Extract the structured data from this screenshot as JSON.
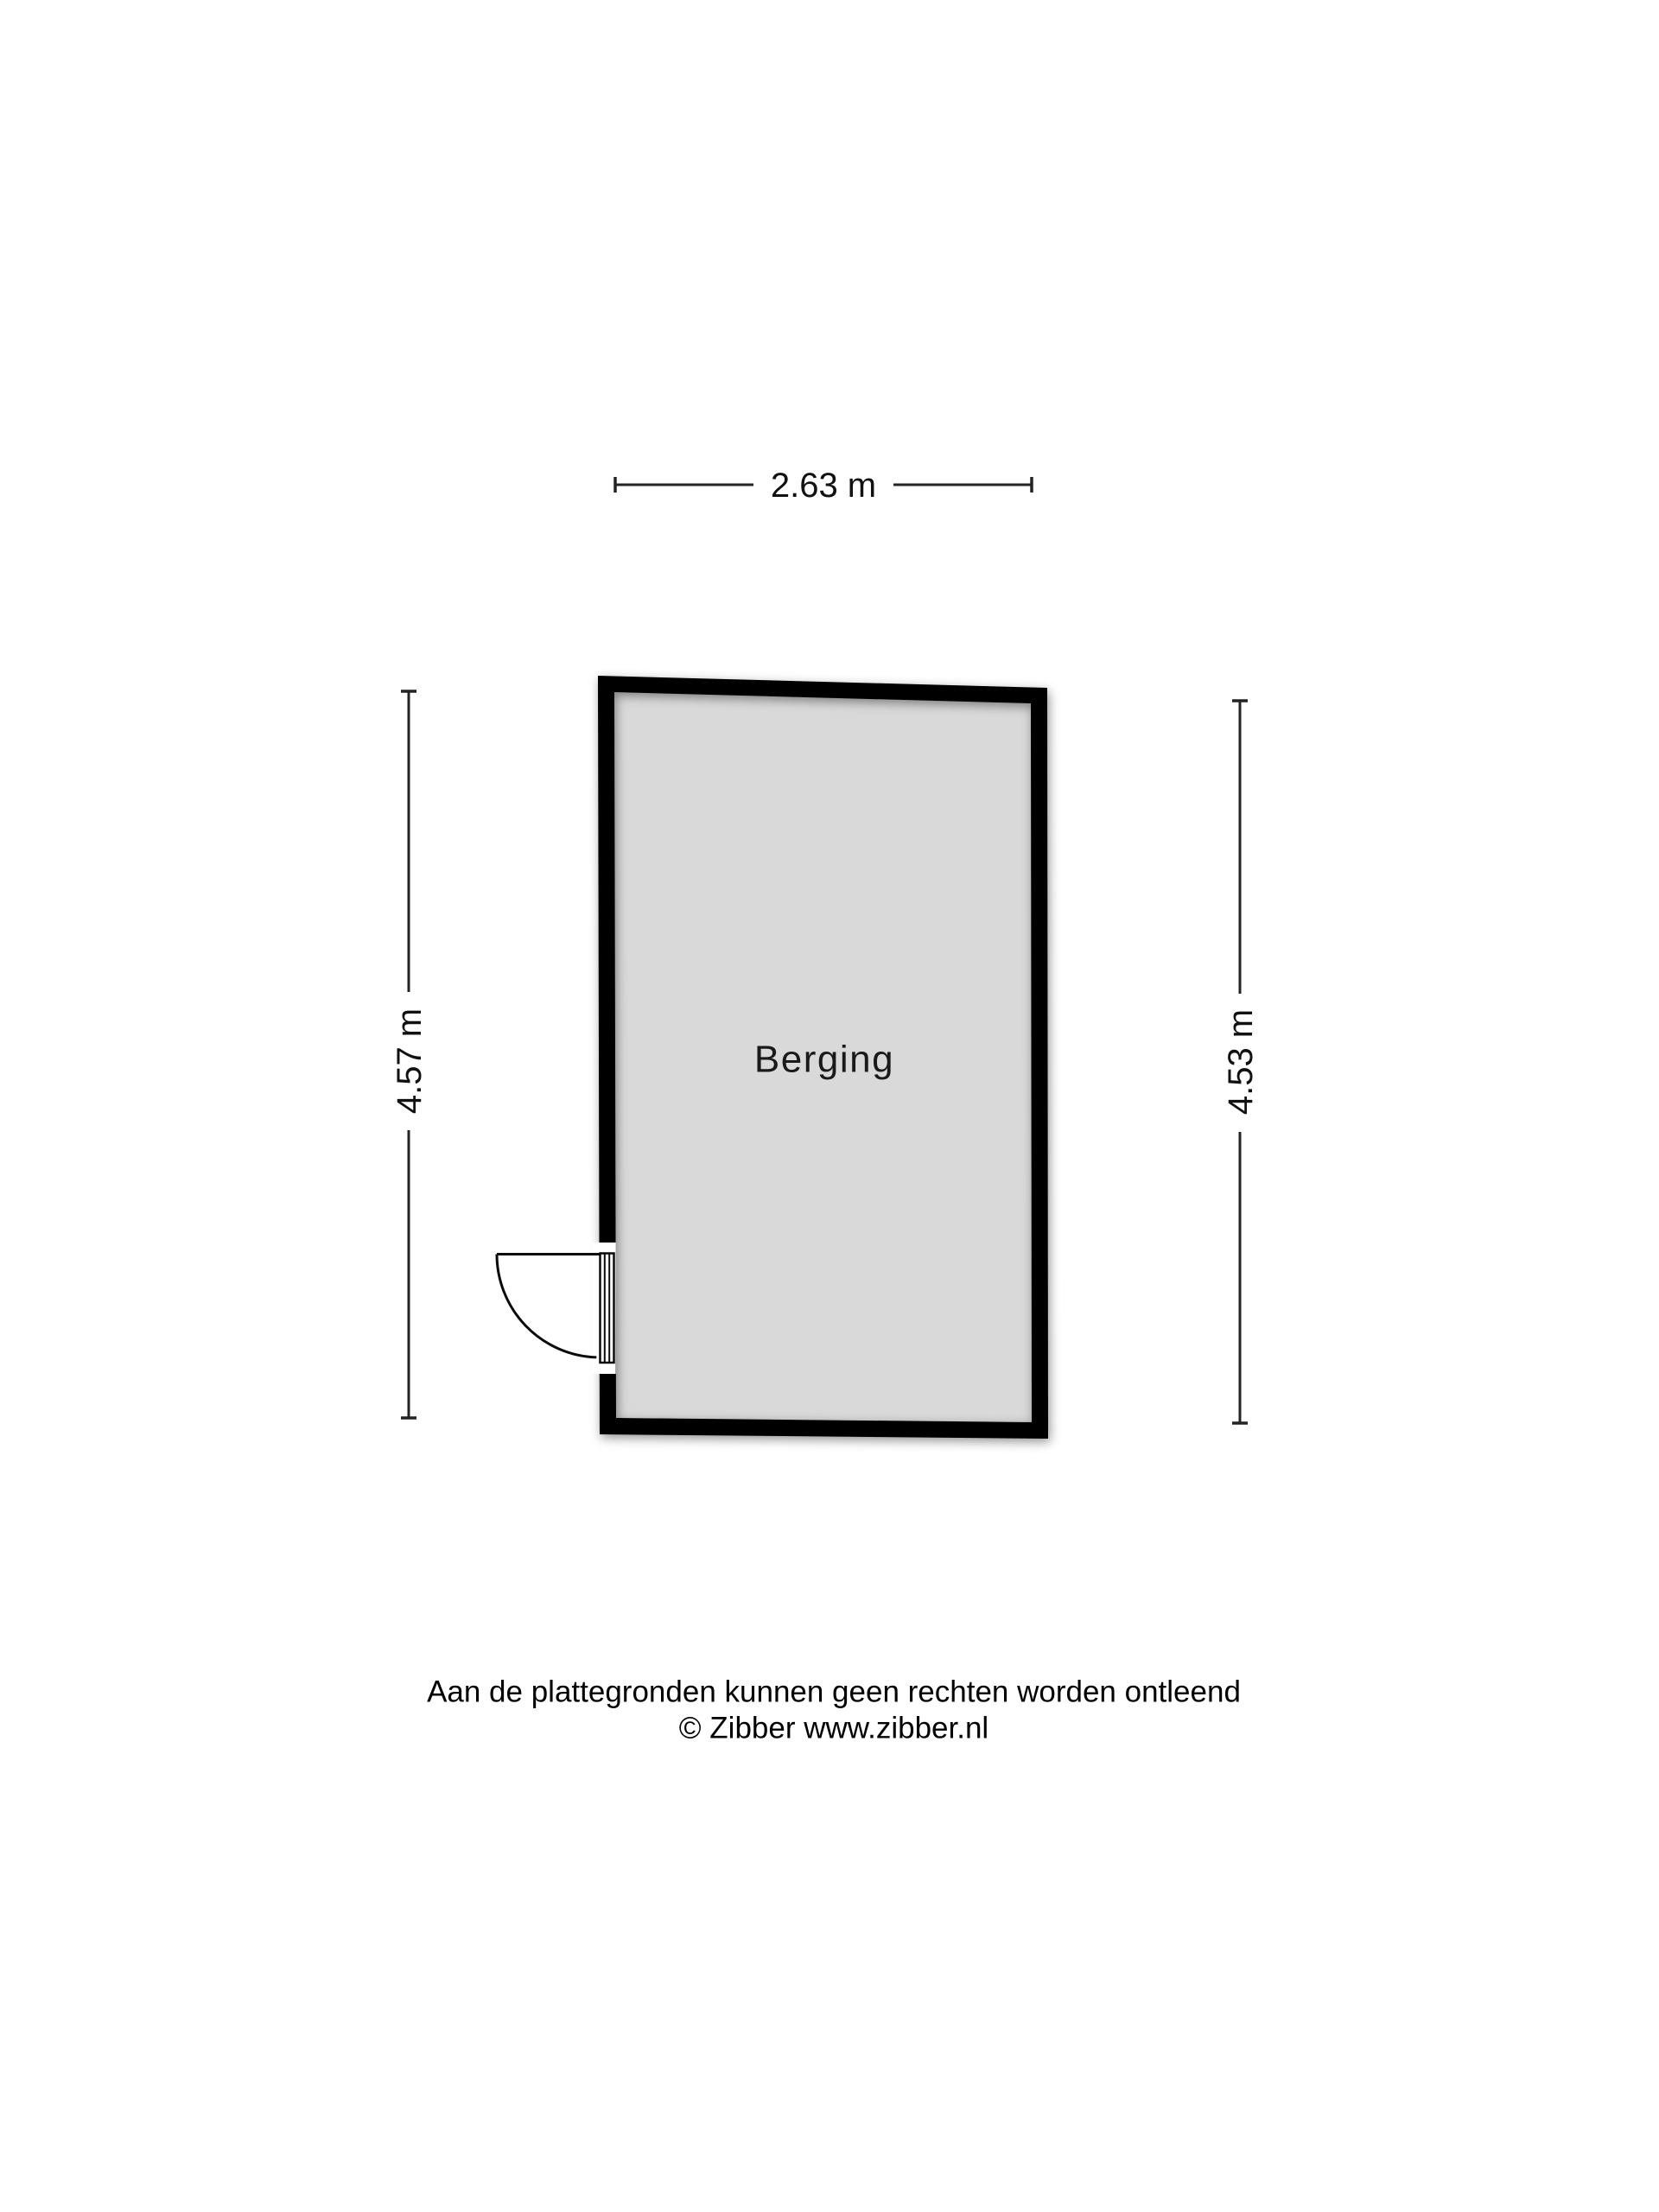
{
  "page": {
    "background": "#ffffff"
  },
  "floorplan": {
    "room_label": "Berging",
    "dimensions": {
      "top": "2.63 m",
      "left": "4.57 m",
      "right": "4.53 m"
    },
    "colors": {
      "floor": "#d9d9d9",
      "wall": "#000000",
      "ink": "#232323"
    },
    "footer": {
      "line1": "Aan de plattegronden kunnen geen rechten worden ontleend",
      "line2": "© Zibber www.zibber.nl"
    }
  }
}
